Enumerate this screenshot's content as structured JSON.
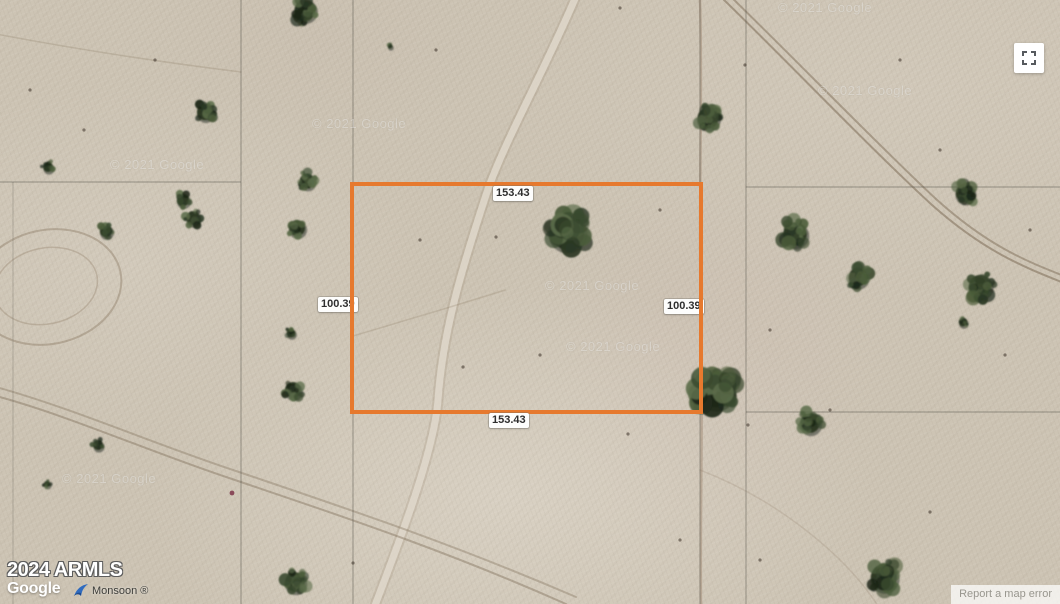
{
  "map": {
    "view_type": "satellite",
    "attribution": {
      "armls_text": "2024 ARMLS",
      "google_logo_text": "Google",
      "provider_text": "Monsoon ®",
      "report_error_text": "Report a map error"
    },
    "watermark_text": "© 2021 Google",
    "watermarks": [
      {
        "x": 312,
        "y": 116
      },
      {
        "x": 778,
        "y": 0
      },
      {
        "x": 818,
        "y": 83
      },
      {
        "x": 545,
        "y": 278
      },
      {
        "x": 566,
        "y": 339
      },
      {
        "x": 62,
        "y": 471
      },
      {
        "x": 110,
        "y": 157
      }
    ],
    "parcel": {
      "border_color": "#e6792e",
      "labels": {
        "top": "153.43",
        "bottom": "153.43",
        "left": "100.39",
        "right": "100.39"
      }
    },
    "controls": {
      "fullscreen_icon": "fullscreen-corners-icon"
    },
    "terrain": {
      "base_color": "#cdc4b4",
      "grid_line_color": "#55534a",
      "tree_colors": [
        "#1d2719",
        "#2b3825",
        "#3a4a2f",
        "#4c5d3b",
        "#5b6c49"
      ],
      "grid_lines": [
        {
          "x1": 241,
          "y1": 0,
          "x2": 241,
          "y2": 604,
          "o": 0.5
        },
        {
          "x1": 353,
          "y1": 0,
          "x2": 353,
          "y2": 604,
          "o": 0.5
        },
        {
          "x1": 700,
          "y1": 0,
          "x2": 700,
          "y2": 604,
          "o": 0.45
        },
        {
          "x1": 746,
          "y1": 0,
          "x2": 746,
          "y2": 604,
          "o": 0.48
        },
        {
          "x1": 13,
          "y1": 182,
          "x2": 13,
          "y2": 604,
          "o": 0.28
        },
        {
          "x1": 0,
          "y1": 182,
          "x2": 241,
          "y2": 182,
          "o": 0.5
        },
        {
          "x1": 746,
          "y1": 187,
          "x2": 1060,
          "y2": 187,
          "o": 0.5
        },
        {
          "x1": 746,
          "y1": 412,
          "x2": 1060,
          "y2": 412,
          "o": 0.5
        }
      ],
      "trails": [
        {
          "d": "M577,-6 C545,70 505,140 487,192 C462,268 443,330 438,400 C434,452 400,540 374,608",
          "color": "rgba(150,132,108,0.22)",
          "width": 11
        },
        {
          "d": "M577,-6 C545,70 505,140 487,192 C462,268 443,330 438,400 C434,452 400,540 374,608",
          "color": "rgba(228,221,209,0.75)",
          "width": 7
        },
        {
          "d": "M720,-4 C790,64 872,150 932,205 C985,252 1024,267 1064,283",
          "color": "rgba(118,100,78,0.5)",
          "width": 2
        },
        {
          "d": "M726,-8 C796,60 877,144 936,199 C988,246 1026,261 1064,276",
          "color": "rgba(118,100,78,0.45)",
          "width": 2
        },
        {
          "d": "M-4,396 C70,416 150,452 232,479 C332,513 440,548 566,604",
          "color": "rgba(125,107,85,0.42)",
          "width": 2
        },
        {
          "d": "M-4,387 C72,408 154,444 236,471 C336,505 446,541 576,597",
          "color": "rgba(125,107,85,0.36)",
          "width": 2
        },
        {
          "d": "M700,0 C703,100 698,210 701,320 C703,430 700,520 701,604",
          "color": "rgba(152,128,106,0.45)",
          "width": 2.5
        },
        {
          "d": "M-4,34 C70,48 160,62 241,72",
          "color": "rgba(135,118,96,0.25)",
          "width": 1.5
        },
        {
          "d": "M353,336 C420,316 468,302 505,290",
          "color": "rgba(140,122,100,0.25)",
          "width": 1.5
        },
        {
          "d": "M700,470 C778,500 846,556 878,606",
          "color": "rgba(140,122,100,0.2)",
          "width": 1.5
        }
      ],
      "track_ovals": [
        {
          "cx": 48,
          "cy": 287,
          "rx": 74,
          "ry": 57,
          "rotate": -12,
          "color": "rgba(135,117,94,0.4)",
          "width": 2
        },
        {
          "cx": 46,
          "cy": 286,
          "rx": 52,
          "ry": 38,
          "rotate": -12,
          "color": "rgba(135,117,94,0.3)",
          "width": 1.5
        }
      ],
      "trees": [
        {
          "x": 305,
          "y": 10,
          "r": 17
        },
        {
          "x": 390,
          "y": 46,
          "r": 4
        },
        {
          "x": 205,
          "y": 112,
          "r": 13
        },
        {
          "x": 48,
          "y": 167,
          "r": 8
        },
        {
          "x": 106,
          "y": 231,
          "r": 10
        },
        {
          "x": 183,
          "y": 200,
          "r": 10
        },
        {
          "x": 193,
          "y": 218,
          "r": 11
        },
        {
          "x": 307,
          "y": 181,
          "r": 12
        },
        {
          "x": 297,
          "y": 228,
          "r": 13
        },
        {
          "x": 291,
          "y": 333,
          "r": 7
        },
        {
          "x": 293,
          "y": 390,
          "r": 13
        },
        {
          "x": 295,
          "y": 582,
          "r": 16
        },
        {
          "x": 98,
          "y": 445,
          "r": 8
        },
        {
          "x": 47,
          "y": 484,
          "r": 5
        },
        {
          "x": 567,
          "y": 232,
          "r": 28
        },
        {
          "x": 708,
          "y": 118,
          "r": 17
        },
        {
          "x": 716,
          "y": 390,
          "r": 28
        },
        {
          "x": 795,
          "y": 234,
          "r": 19
        },
        {
          "x": 858,
          "y": 277,
          "r": 15
        },
        {
          "x": 980,
          "y": 286,
          "r": 18
        },
        {
          "x": 963,
          "y": 322,
          "r": 7
        },
        {
          "x": 965,
          "y": 193,
          "r": 15
        },
        {
          "x": 810,
          "y": 423,
          "r": 16
        },
        {
          "x": 884,
          "y": 577,
          "r": 21
        }
      ],
      "specks": [
        {
          "x": 496,
          "y": 237
        },
        {
          "x": 463,
          "y": 367
        },
        {
          "x": 540,
          "y": 355
        },
        {
          "x": 436,
          "y": 50
        },
        {
          "x": 620,
          "y": 8
        },
        {
          "x": 745,
          "y": 65
        },
        {
          "x": 940,
          "y": 150
        },
        {
          "x": 1005,
          "y": 355
        },
        {
          "x": 930,
          "y": 512
        },
        {
          "x": 232,
          "y": 493,
          "color": "#8a4a5a",
          "r": 2.4
        },
        {
          "x": 628,
          "y": 434
        },
        {
          "x": 748,
          "y": 425
        },
        {
          "x": 353,
          "y": 563
        },
        {
          "x": 155,
          "y": 60
        },
        {
          "x": 84,
          "y": 130
        },
        {
          "x": 30,
          "y": 90
        },
        {
          "x": 770,
          "y": 330
        },
        {
          "x": 830,
          "y": 410
        },
        {
          "x": 680,
          "y": 540
        },
        {
          "x": 760,
          "y": 560
        },
        {
          "x": 420,
          "y": 240
        },
        {
          "x": 660,
          "y": 210
        },
        {
          "x": 900,
          "y": 60
        },
        {
          "x": 1030,
          "y": 230
        }
      ]
    }
  }
}
